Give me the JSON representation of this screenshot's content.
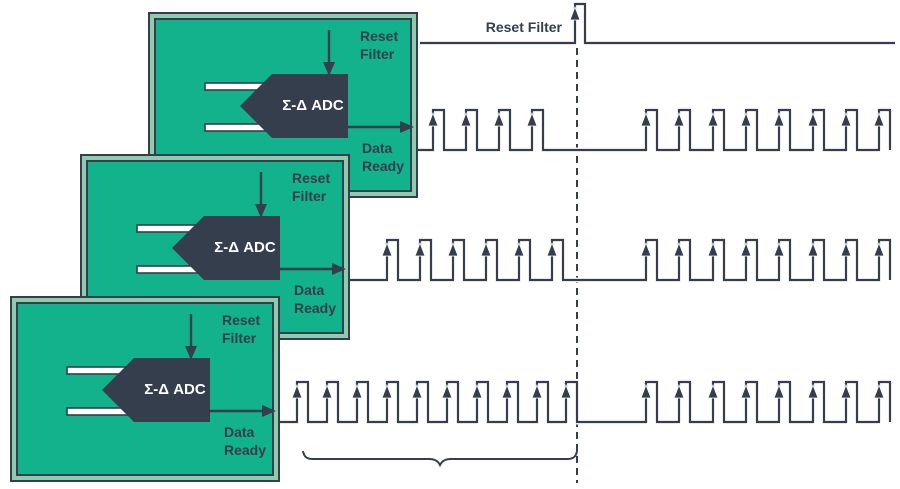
{
  "colors": {
    "card_green": "#12B28C",
    "card_frame_green": "#8FCBAC",
    "navy": "#343E4D",
    "white": "#FFFFFF",
    "background": "#FFFFFF"
  },
  "card_labels": {
    "reset_line1": "Reset",
    "reset_line2": "Filter",
    "adc": "Σ-Δ ADC",
    "data_line1": "Data",
    "data_line2": "Ready"
  },
  "timing": {
    "reset_label": "Reset Filter",
    "reset_wave": {
      "y": 43,
      "x1": 420,
      "x2": 895,
      "pulse_x": 575,
      "pulse_w": 10,
      "top": 4
    },
    "data_ready_waves": [
      {
        "y": 150,
        "top": 110,
        "x1": 418,
        "x2": 890,
        "w": 11,
        "pre": [
          433,
          466,
          499,
          532
        ],
        "post": [
          646,
          679,
          713,
          746,
          779,
          813,
          846,
          879
        ]
      },
      {
        "y": 280,
        "top": 240,
        "x1": 350,
        "x2": 890,
        "w": 11,
        "pre": [
          387,
          420,
          453,
          486,
          519,
          552
        ],
        "post": [
          646,
          679,
          713,
          746,
          779,
          813,
          846,
          879
        ]
      },
      {
        "y": 422,
        "top": 382,
        "x1": 280,
        "x2": 890,
        "w": 11,
        "pre": [
          297,
          327,
          357,
          387,
          417,
          447,
          477,
          507,
          537,
          566
        ],
        "post": [
          646,
          679,
          713,
          746,
          779,
          813,
          846,
          879
        ]
      }
    ],
    "sync_line": {
      "x": 577,
      "y1": 48,
      "y2": 483,
      "dash": "7 5"
    },
    "brace": {
      "x1": 303,
      "x2": 577,
      "y": 459
    }
  }
}
